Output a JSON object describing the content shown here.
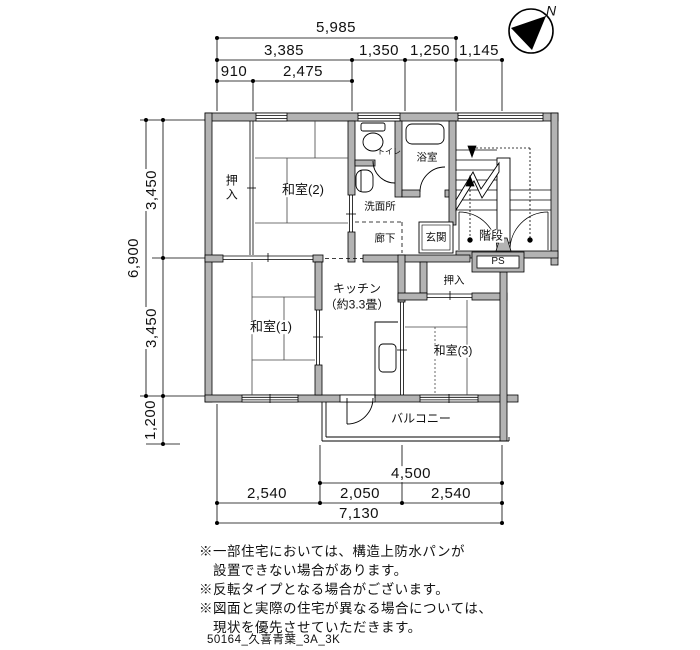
{
  "compass": {
    "north_label": "N"
  },
  "dimensions": {
    "top": {
      "total": "5,985",
      "row2": [
        "3,385",
        "1,350",
        "1,250",
        "1,145"
      ],
      "row3": [
        "910",
        "2,475"
      ]
    },
    "left": {
      "total": "6,900",
      "segments": [
        "3,450",
        "3,450"
      ],
      "balcony": "1,200"
    },
    "bottom": {
      "upper": "4,500",
      "row": [
        "2,540",
        "2,050",
        "2,540"
      ],
      "total": "7,130"
    }
  },
  "rooms": {
    "oshiire_upper": "押入",
    "washitsu2": "和室(2)",
    "toilet": "トイレ",
    "bathroom": "浴室",
    "washroom": "洗面所",
    "hallway": "廊下",
    "entrance": "玄関",
    "stairs": "階段",
    "ps": "PS",
    "oshiire_lower": "押入",
    "washitsu1": "和室(1)",
    "kitchen_line1": "キッチン",
    "kitchen_line2": "（約3.3畳）",
    "washitsu3": "和室(3)",
    "balcony": "バルコニー"
  },
  "notes": [
    "※一部住宅においては、構造上防水パンが",
    "　設置できない場合があります。",
    "※反転タイプとなる場合がございます。",
    "※図面と実際の住宅が異なる場合については、",
    "　現状を優先させていただきます。"
  ],
  "plan_id": "50164_久喜青葉_3A_3K"
}
